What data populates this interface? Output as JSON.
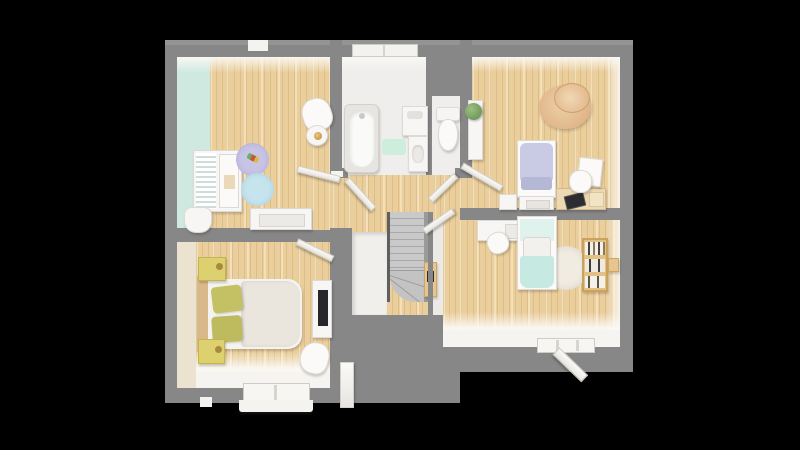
{
  "scene": {
    "type": "3d-floor-plan-top-view",
    "background_color": "#000000",
    "palette": {
      "wall_gray": "#878787",
      "wood_floor": "#eace9c",
      "bathroom_floor": "#efeeec",
      "mint_accent": "#cfe9e0",
      "cream_accent": "#ece2d0",
      "lavender": "#c8c4e6",
      "light_blue": "#c5e4ee",
      "mint_bed": "#c6e9e1",
      "olive_pillow": "#c0bf66",
      "yellow_nightstand": "#ddd06e",
      "tan_hat": "#e0b183",
      "stair_gray": "#c6c6c6",
      "wood_furniture": "#e7c58d",
      "plant_green": "#7ca86d",
      "screen_dark": "#2b2b30"
    },
    "rooms": [
      {
        "name": "kids-bedroom-top-left",
        "furniture": [
          "open-wardrobe-shelf",
          "laundry-basket",
          "white-dresser",
          "lavender-round-rug",
          "toy",
          "blue-round-rug",
          "desk-chair",
          "side-table-with-lamp",
          "window-top-wall"
        ]
      },
      {
        "name": "bathroom",
        "furniture": [
          "bathtub",
          "washing-machine",
          "vanity-sink",
          "mint-bath-mat",
          "window-top-wall",
          "open-door"
        ]
      },
      {
        "name": "wc",
        "furniture": [
          "toilet",
          "open-door"
        ]
      },
      {
        "name": "bedroom-top-right",
        "furniture": [
          "single-bed-lavender",
          "storage-bench",
          "nightstand",
          "wall-cabinet-with-plant",
          "sun-hat-pouf",
          "desk-with-laptop",
          "printer",
          "desk-chair",
          "open-door"
        ]
      },
      {
        "name": "bedroom-bottom-left",
        "furniture": [
          "double-bed",
          "olive-pillows",
          "yellow-nightstand-top",
          "yellow-nightstand-bottom",
          "tv-stand",
          "tv",
          "armchair",
          "window-bottom-wall",
          "white-door-panel",
          "open-door"
        ]
      },
      {
        "name": "bedroom-bottom-right",
        "furniture": [
          "single-bed-mint",
          "wall-desk",
          "desk-chair",
          "round-rug",
          "bookshelf",
          "open-window-bottom-wall",
          "open-door"
        ]
      },
      {
        "name": "hallway-landing",
        "furniture": [
          "staircase",
          "stair-railing",
          "stair-closet",
          "wall-mounted-cabinet"
        ]
      }
    ]
  }
}
